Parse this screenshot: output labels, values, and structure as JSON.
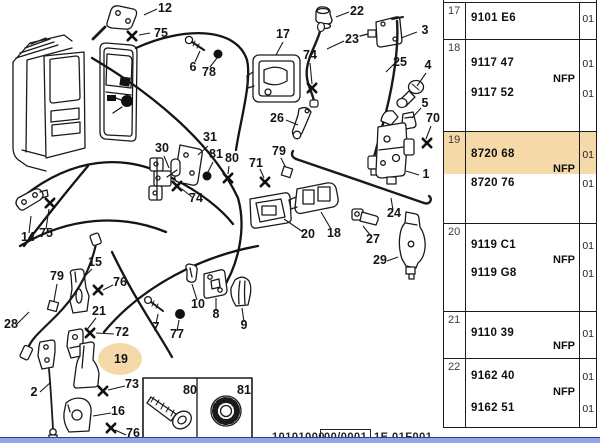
{
  "diagram": {
    "highlight": {
      "label": "19",
      "color": "#f6d9a8"
    },
    "callouts": [
      {
        "label": "12",
        "x": 165,
        "y": 12
      },
      {
        "label": "75",
        "x": 161,
        "y": 37
      },
      {
        "label": "6",
        "x": 193,
        "y": 71
      },
      {
        "label": "78",
        "x": 209,
        "y": 76
      },
      {
        "label": "17",
        "x": 283,
        "y": 38
      },
      {
        "label": "74",
        "x": 310,
        "y": 59
      },
      {
        "label": "22",
        "x": 357,
        "y": 15
      },
      {
        "label": "23",
        "x": 352,
        "y": 43
      },
      {
        "label": "3",
        "x": 425,
        "y": 34
      },
      {
        "label": "25",
        "x": 400,
        "y": 66
      },
      {
        "label": "4",
        "x": 428,
        "y": 69
      },
      {
        "label": "5",
        "x": 425,
        "y": 107
      },
      {
        "label": "70",
        "x": 433,
        "y": 122
      },
      {
        "label": "26",
        "x": 277,
        "y": 122
      },
      {
        "label": "79",
        "x": 279,
        "y": 155
      },
      {
        "label": "71",
        "x": 256,
        "y": 167
      },
      {
        "label": "1",
        "x": 426,
        "y": 178
      },
      {
        "label": "24",
        "x": 394,
        "y": 217
      },
      {
        "label": "20",
        "x": 308,
        "y": 238
      },
      {
        "label": "18",
        "x": 334,
        "y": 237
      },
      {
        "label": "27",
        "x": 373,
        "y": 243
      },
      {
        "label": "29",
        "x": 380,
        "y": 264
      },
      {
        "label": "30",
        "x": 162,
        "y": 152
      },
      {
        "label": "31",
        "x": 210,
        "y": 141
      },
      {
        "label": "81",
        "x": 216,
        "y": 158
      },
      {
        "label": "80",
        "x": 232,
        "y": 162
      },
      {
        "label": "74",
        "x": 196,
        "y": 202
      },
      {
        "label": "14",
        "x": 28,
        "y": 241
      },
      {
        "label": "75",
        "x": 46,
        "y": 237
      },
      {
        "label": "15",
        "x": 95,
        "y": 266
      },
      {
        "label": "76",
        "x": 120,
        "y": 286
      },
      {
        "label": "79",
        "x": 57,
        "y": 280
      },
      {
        "label": "21",
        "x": 99,
        "y": 315
      },
      {
        "label": "72",
        "x": 122,
        "y": 336
      },
      {
        "label": "28",
        "x": 11,
        "y": 328
      },
      {
        "label": "2",
        "x": 34,
        "y": 396
      },
      {
        "label": "19",
        "x": 121,
        "y": 363,
        "highlight": true
      },
      {
        "label": "73",
        "x": 132,
        "y": 388
      },
      {
        "label": "16",
        "x": 118,
        "y": 415
      },
      {
        "label": "76",
        "x": 133,
        "y": 437
      },
      {
        "label": "7",
        "x": 156,
        "y": 331
      },
      {
        "label": "77",
        "x": 177,
        "y": 338
      },
      {
        "label": "10",
        "x": 198,
        "y": 308
      },
      {
        "label": "8",
        "x": 216,
        "y": 318
      },
      {
        "label": "9",
        "x": 244,
        "y": 329
      }
    ],
    "inset_labels": [
      {
        "label": "80",
        "x": 190,
        "y": 394
      },
      {
        "label": "81",
        "x": 244,
        "y": 394
      }
    ]
  },
  "table": {
    "highlight_color": "#f6d9a8",
    "rows": [
      {
        "ref": "17",
        "parts": [
          {
            "number": "9101 E6",
            "qty": "01"
          }
        ],
        "nfp": "",
        "highlighted": false
      },
      {
        "ref": "18",
        "parts": [
          {
            "number": "9117 47",
            "qty": "01"
          },
          {
            "number": "9117 52",
            "qty": "01"
          }
        ],
        "nfp": "NFP",
        "highlighted": false
      },
      {
        "ref": "19",
        "parts": [
          {
            "number": "8720 68",
            "qty": "01"
          },
          {
            "number": "8720 76",
            "qty": "01"
          }
        ],
        "nfp": "NFP",
        "highlighted": true
      },
      {
        "ref": "20",
        "parts": [
          {
            "number": "9119 C1",
            "qty": "01"
          },
          {
            "number": "9119 G8",
            "qty": "01"
          }
        ],
        "nfp": "NFP",
        "highlighted": false
      },
      {
        "ref": "21",
        "parts": [
          {
            "number": "9110 39",
            "qty": "01"
          }
        ],
        "nfp": "NFP",
        "highlighted": false
      },
      {
        "ref": "22",
        "parts": [
          {
            "number": "9162 40",
            "qty": "01"
          },
          {
            "number": "9162 51",
            "qty": "01"
          }
        ],
        "nfp": "NFP",
        "highlighted": false
      }
    ]
  },
  "footer": {
    "left_code": "10101000",
    "boxed_code": "00/0001",
    "right_code": "1E 01F001"
  }
}
